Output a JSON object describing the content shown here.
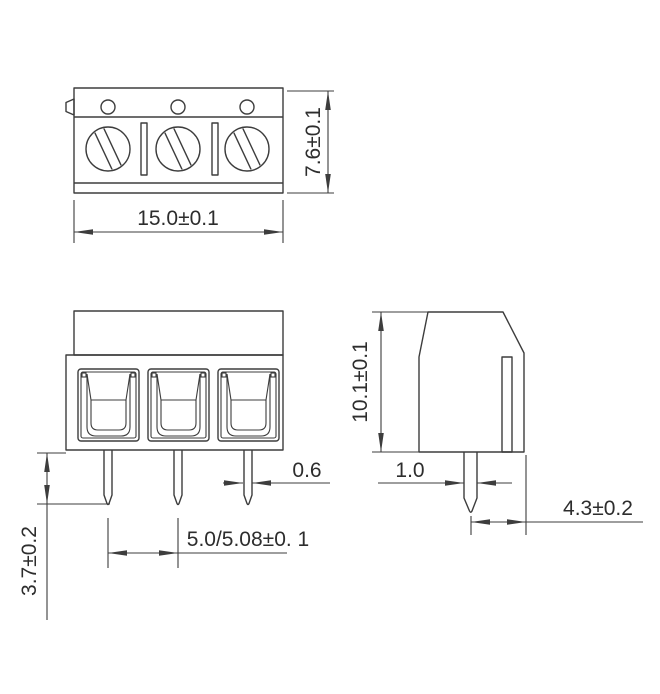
{
  "dimensions": {
    "top_view": {
      "width": "15.0±0.1",
      "height": "7.6±0.1"
    },
    "front_view": {
      "pin_length": "3.7±0.2",
      "pin_pitch": "5.0/5.08±0. 1",
      "pin_width": "0.6"
    },
    "side_view": {
      "height": "10.1±0.1",
      "pin_width": "1.0",
      "pin_center_to_edge": "4.3±0.2"
    }
  },
  "colors": {
    "line": "#3d3d3d",
    "text": "#2d2d2d",
    "background": "#ffffff"
  }
}
